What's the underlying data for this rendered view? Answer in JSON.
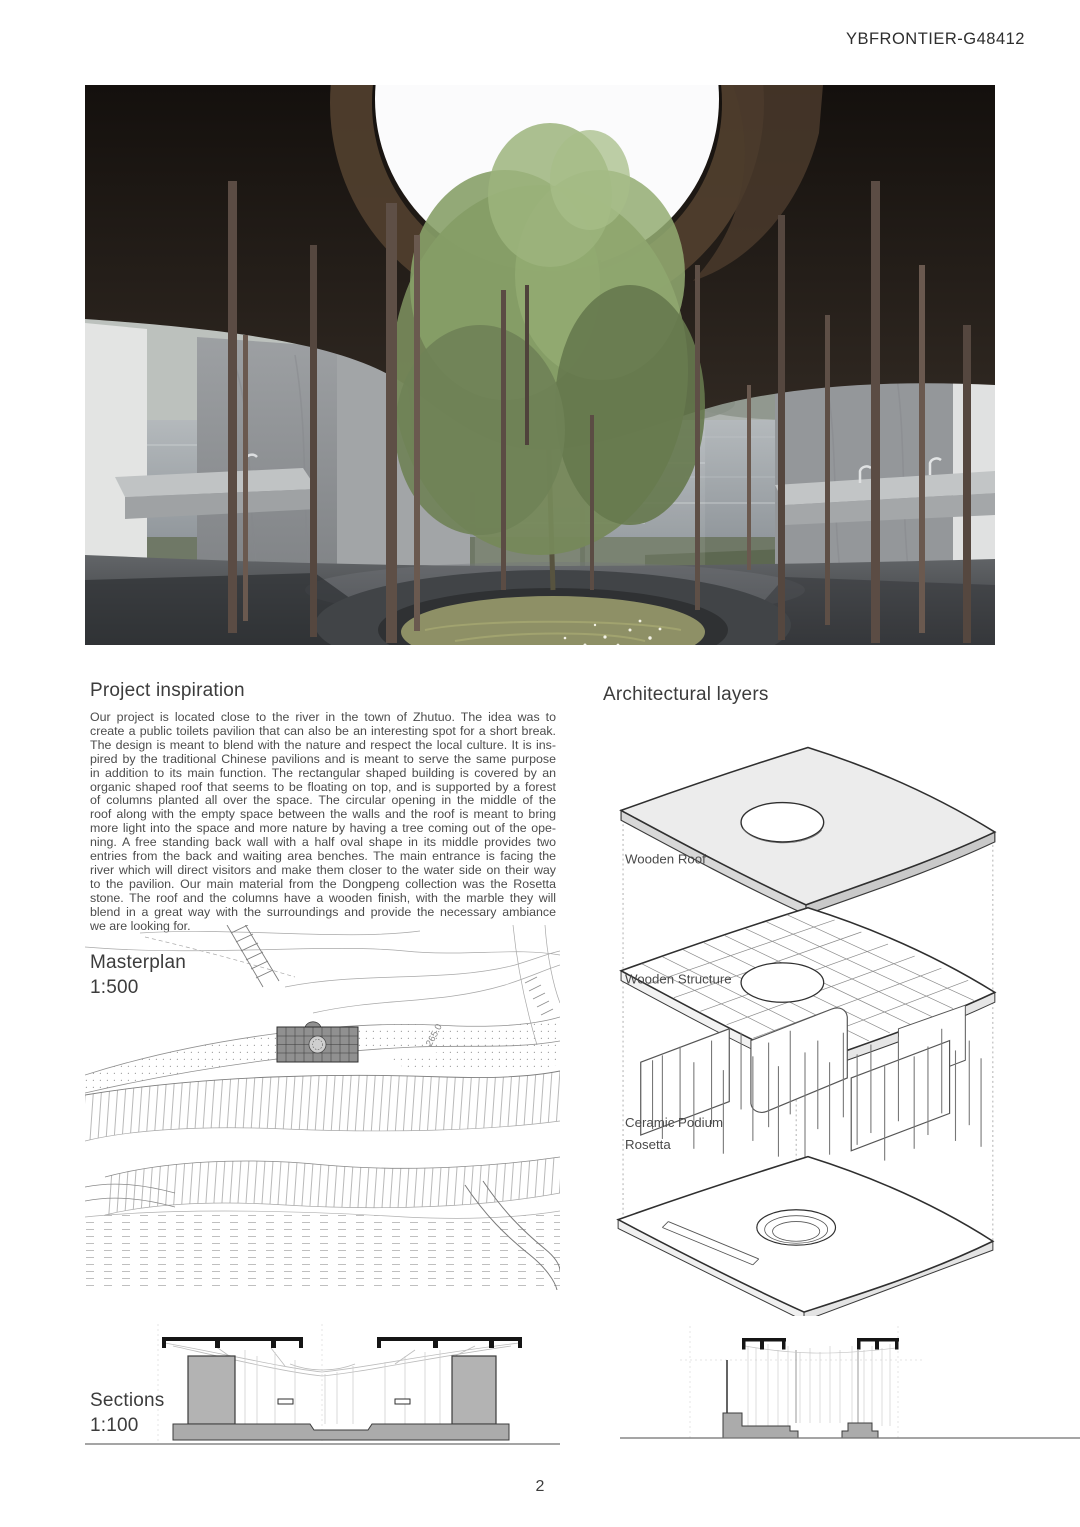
{
  "header": {
    "code": "YBFRONTIER-G48412"
  },
  "inspiration": {
    "title": "Project inspiration",
    "lines": [
      "Our project is located close to the river in the town of Zhutuo. The idea was to",
      "create a public toilets pavilion that can also be an interesting spot for a short break.",
      "The design is meant to blend with the nature and respect the local culture. It is ins-",
      "pired by the traditional Chinese pavilions and is meant to serve the same purpose",
      "in addition to its main function. The rectangular shaped building is covered by an",
      "organic shaped roof that seems to be floating on top, and is supported by a forest",
      "of columns planted all over the space. The circular opening in the middle of the",
      "roof along with the empty space between the walls and the roof is meant to bring",
      "more light into the space and more nature by having a tree coming out of the ope-",
      "ning. A free standing back wall with a half oval shape in its middle provides two",
      "entries from the back and waiting area benches. The main entrance is facing the",
      "river which will direct visitors and make them closer to the water side on their way",
      "to the pavilion. Our main material from the Dongpeng collection was the Rosetta",
      "stone. The roof and the columns have a wooden finish, with the marble they will",
      "blend in a great way with the surroundings and provide the necessary ambiance",
      "we are looking for."
    ]
  },
  "layers": {
    "title": "Architectural layers",
    "roof_label": "Wooden Roof",
    "structure_label": "Wooden Structure",
    "podium_label_line1": "Ceramic Podium",
    "podium_label_line2": "Rosetta"
  },
  "masterplan": {
    "title": "Masterplan",
    "scale": "1:500",
    "contour_label": "265.0"
  },
  "sections": {
    "title": "Sections",
    "scale": "1:100"
  },
  "footer": {
    "page_number": "2"
  },
  "colors": {
    "ceiling_wood": "#221c17",
    "column_wood": "#5d4c43",
    "marble_wall": "#94979a",
    "foliage_green": "#81935f",
    "water_gray": "#9aa0a4",
    "drawing_line": "#9a9a9a",
    "podium_gray": "#ababab",
    "roof_black": "#151515"
  }
}
